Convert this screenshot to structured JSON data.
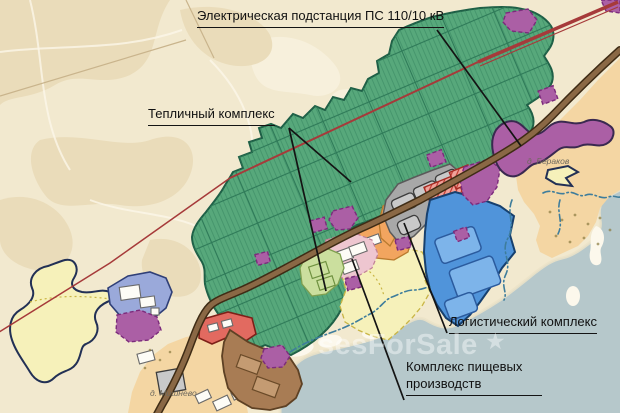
{
  "map": {
    "callouts": {
      "substation": "Электрическая подстанция ПС 110/10 кВ",
      "greenhouse": "Тепличный комплекс",
      "logistics": "Логистический комплекс",
      "food": "Комплекс пищевых производств"
    },
    "villages": {
      "berakov": "д. Бераков",
      "mishnevo": "д. Мишнево"
    },
    "watermark": {
      "text": "sesForSale",
      "star": "★"
    }
  },
  "colors": {
    "background": "#f2e9cf",
    "field_patch": "#eadcba",
    "water": "#b6c8cb",
    "village_tan": "#f4d6a3",
    "greenhouse_green": "#57a87b",
    "green_outline": "#1e5f46",
    "zone_purple": "#ab5fa5",
    "zone_blue": "#5094da",
    "zone_periwinkle": "#9aa9da",
    "zone_yellow": "#f6f1ba",
    "zone_pink": "#eec6d0",
    "zone_lightgreen": "#cbdf9e",
    "zone_orange": "#f2a55f",
    "zone_coral": "#e26a60",
    "zone_brown": "#a87c54",
    "zone_gray": "#a8a8a8",
    "road_brown": "#8a6845",
    "powerline_red": "#a63a3a",
    "label_text": "#111111",
    "watermark": "rgba(255,255,255,0.42)"
  }
}
